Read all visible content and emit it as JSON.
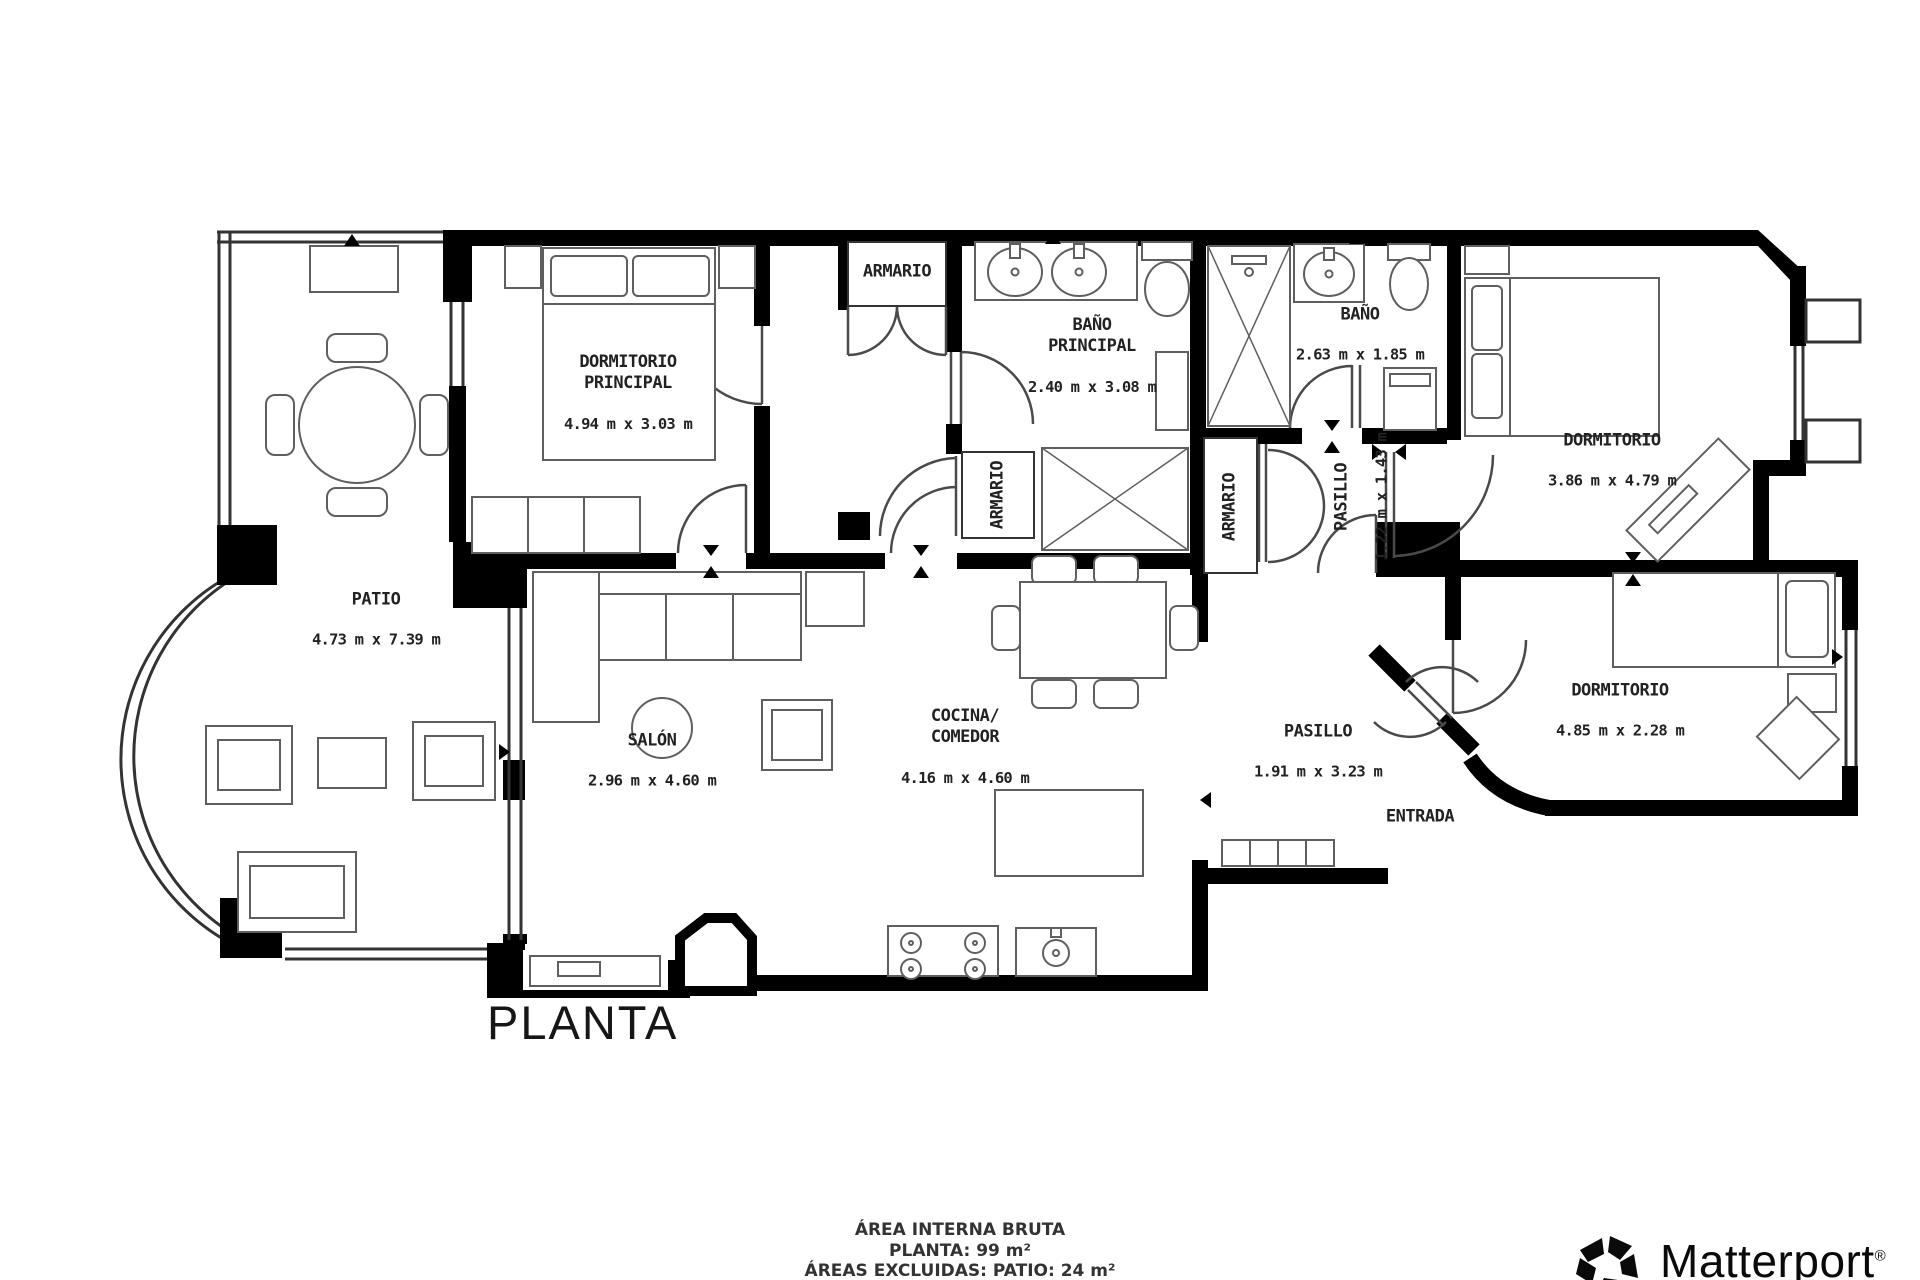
{
  "plan_title": "PLANTA",
  "rooms": {
    "dormitorio_principal": {
      "name": "DORMITORIO\nPRINCIPAL",
      "dims": "4.94 m x 3.03 m"
    },
    "armario_top": {
      "name": "ARMARIO"
    },
    "bano_principal": {
      "name": "BAÑO\nPRINCIPAL",
      "dims": "2.40 m x 3.08 m"
    },
    "bano": {
      "name": "BAÑO",
      "dims": "2.63 m x 1.85 m"
    },
    "dormitorio_derecha": {
      "name": "DORMITORIO",
      "dims": "3.86 m x 4.79 m"
    },
    "patio": {
      "name": "PATIO",
      "dims": "4.73 m x 7.39 m"
    },
    "armario_vestibulo": {
      "name": "ARMARIO"
    },
    "armario_pasillo": {
      "name": "ARMARIO"
    },
    "pasillo_pequeno": {
      "name": "PASILLO",
      "dims": "1.22 m x 1.43 m"
    },
    "salon": {
      "name": "SALÓN",
      "dims": "2.96 m x 4.60 m"
    },
    "cocina_comedor": {
      "name": "COCINA/\nCOMEDOR",
      "dims": "4.16 m x 4.60 m"
    },
    "pasillo": {
      "name": "PASILLO",
      "dims": "1.91 m x 3.23 m"
    },
    "entrada": {
      "name": "ENTRADA"
    },
    "dormitorio_abajo": {
      "name": "DORMITORIO",
      "dims": "4.85 m x 2.28 m"
    }
  },
  "footer": {
    "line1": "ÁREA INTERNA BRUTA",
    "line2": "PLANTA: 99 m²",
    "line3": "ÁREAS EXCLUIDAS: PATIO: 24 m²"
  },
  "brand": {
    "name": "Matterport",
    "registered": "®"
  },
  "colors": {
    "wall": "#000000",
    "furniture": "#5f5f5f",
    "thin_wall": "#333333",
    "text": "#222222"
  }
}
